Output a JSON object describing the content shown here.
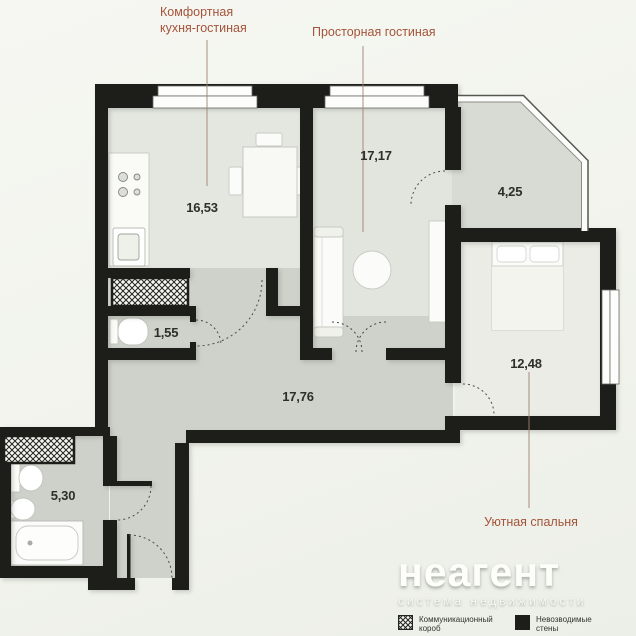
{
  "colors": {
    "background_top": "#f6f7f2",
    "background_bottom": "#ecefe8",
    "wall": "#1d1d1a",
    "room_kitchen": "#e4e7e0",
    "room_living": "#e2e5de",
    "room_bedroom": "#eaece5",
    "room_balcony": "#d8dbd4",
    "room_corridor": "#cfd2ca",
    "room_bathroom": "#ced1ca",
    "window_fill": "#fdfdfb",
    "accent_label": "#a4543a",
    "area_text": "#2e2e2a",
    "leader_line": "#a08274"
  },
  "rooms": {
    "kitchen_living": {
      "label_line1": "Комфортная",
      "label_line2": "кухня-гостиная",
      "area": "16,53"
    },
    "living": {
      "label": "Просторная гостиная",
      "area": "17,17"
    },
    "balcony": {
      "area": "4,25"
    },
    "wc": {
      "area": "1,55"
    },
    "bedroom": {
      "label": "Уютная спальня",
      "area": "12,48"
    },
    "hallway": {
      "area": "17,76"
    },
    "bathroom": {
      "area": "5,30"
    }
  },
  "watermark": {
    "brand": "неагент",
    "tagline": "система недвижимости"
  },
  "legend": {
    "items": [
      {
        "label": "Коммуникационный короб",
        "swatch": "hatch"
      },
      {
        "label": "Невозводимые стены",
        "swatch": "solid"
      }
    ]
  }
}
